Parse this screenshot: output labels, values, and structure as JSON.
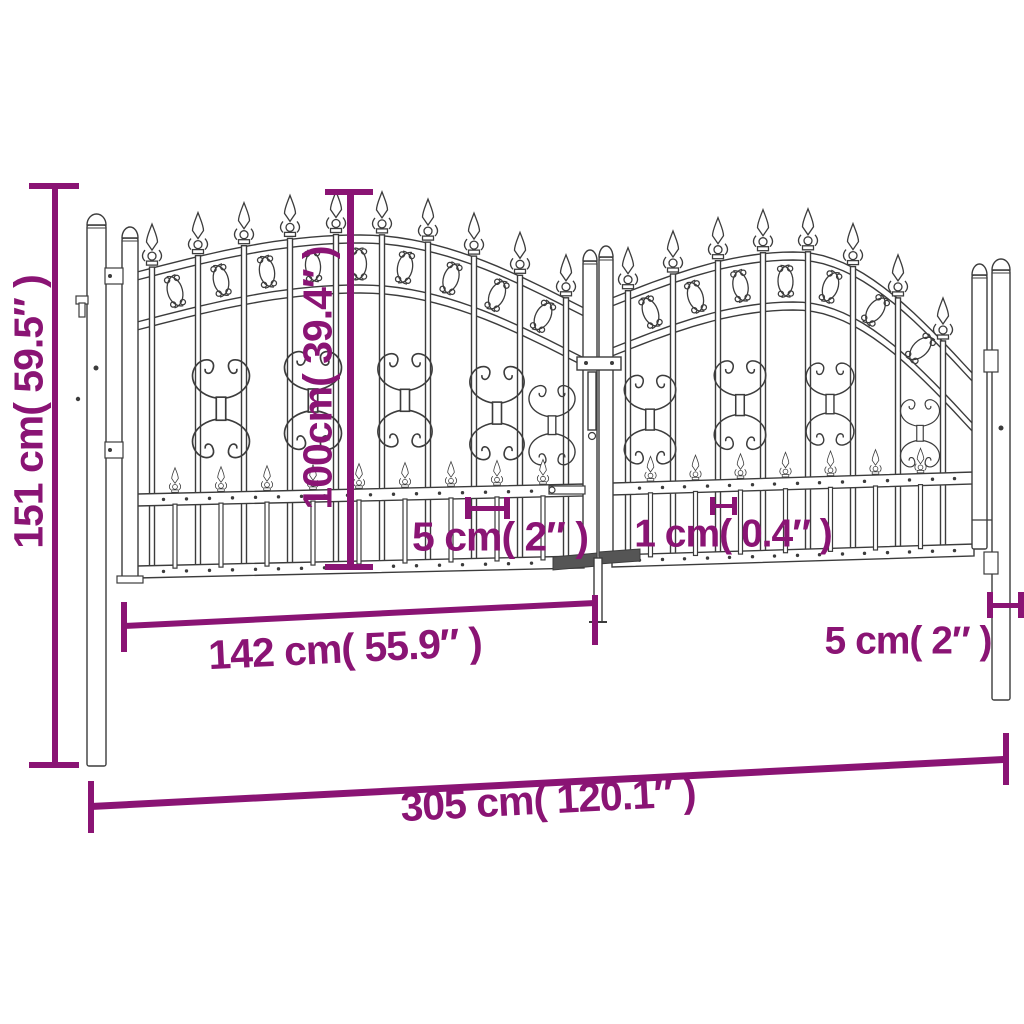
{
  "diagram": {
    "subject": "double-garden-gate-with-spear-top",
    "view": "front-dimension-diagram"
  },
  "dims": {
    "total_height": {
      "label": "151 cm( 59.5″ )"
    },
    "gate_height": {
      "label": "100cm( 39.4″ )"
    },
    "bar_gap_left": {
      "label": "5 cm( 2″ )"
    },
    "gap_1cm": {
      "label": "1 cm( 0.4″ )"
    },
    "leaf_width": {
      "label": "142 cm( 55.9″ )"
    },
    "bar_gap_right": {
      "label": "5 cm( 2″ )"
    },
    "total_width": {
      "label": "305 cm( 120.1″ )"
    }
  },
  "colors": {
    "accent": "#8A1474",
    "line_art": "#3C3C3C",
    "background": "#FFFFFF"
  }
}
